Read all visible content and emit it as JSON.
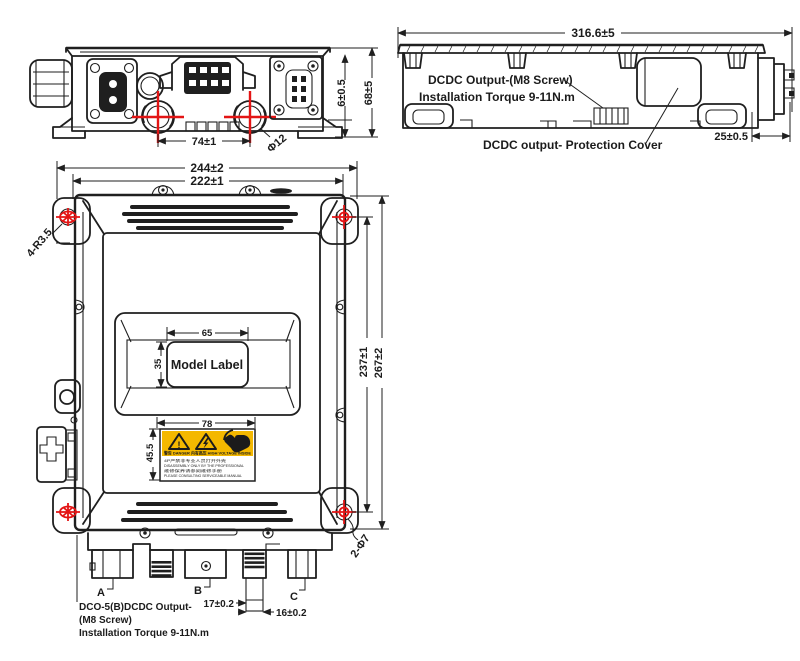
{
  "front_view": {
    "dim_port_pitch": "74±1",
    "dim_port_diameter": "Φ12",
    "dim_lid_height": "6±0.5",
    "dim_total_height": "68±5"
  },
  "side_view": {
    "dim_length": "316.6±5",
    "output_label_line1": "DCDC Output-(M8 Screw)",
    "output_label_line2": "Installation Torque 9-11N.m",
    "cover_label": "DCDC output- Protection Cover",
    "dim_connector_depth": "25±0.5"
  },
  "top_view": {
    "dim_outer_width": "244±2",
    "dim_inner_width": "222±1",
    "corner_radius": "4-R3.5",
    "dim_model_width": "65",
    "dim_model_height": "35",
    "model_label": "Model Label",
    "dim_warn_width": "78",
    "dim_warn_height": "45.5",
    "dim_hole_pitch": "237±1",
    "dim_outer_height": "267±2",
    "mount_holes": "2-Φ7",
    "conn_a": "A",
    "conn_b": "B",
    "conn_c": "C",
    "dim_tube_offset": "17±0.2",
    "dim_tube_width": "16±0.2",
    "dco_line1": "DCO-5(B)DCDC Output-",
    "dco_line2": "(M8 Screw)",
    "dco_line3": "Installation Torque 9-11N.m"
  },
  "warning_label": {
    "exclamation": "!",
    "band": "警告 DANGER   内有高压 HIGH VOLTAGE INSIDE",
    "line1": "4P严禁非专业人员打开外壳",
    "line2": "DISASSEMBLY ONLY BY THE PROFESSIONAL",
    "line3": "维修保养请参阅维修手册",
    "line4": "PLEASE CONSULTING SERVICEABLE MANUAL"
  },
  "colors": {
    "line": "#1f1f1f",
    "marker_red": "#e31414",
    "warning_yellow": "#f4b800"
  }
}
